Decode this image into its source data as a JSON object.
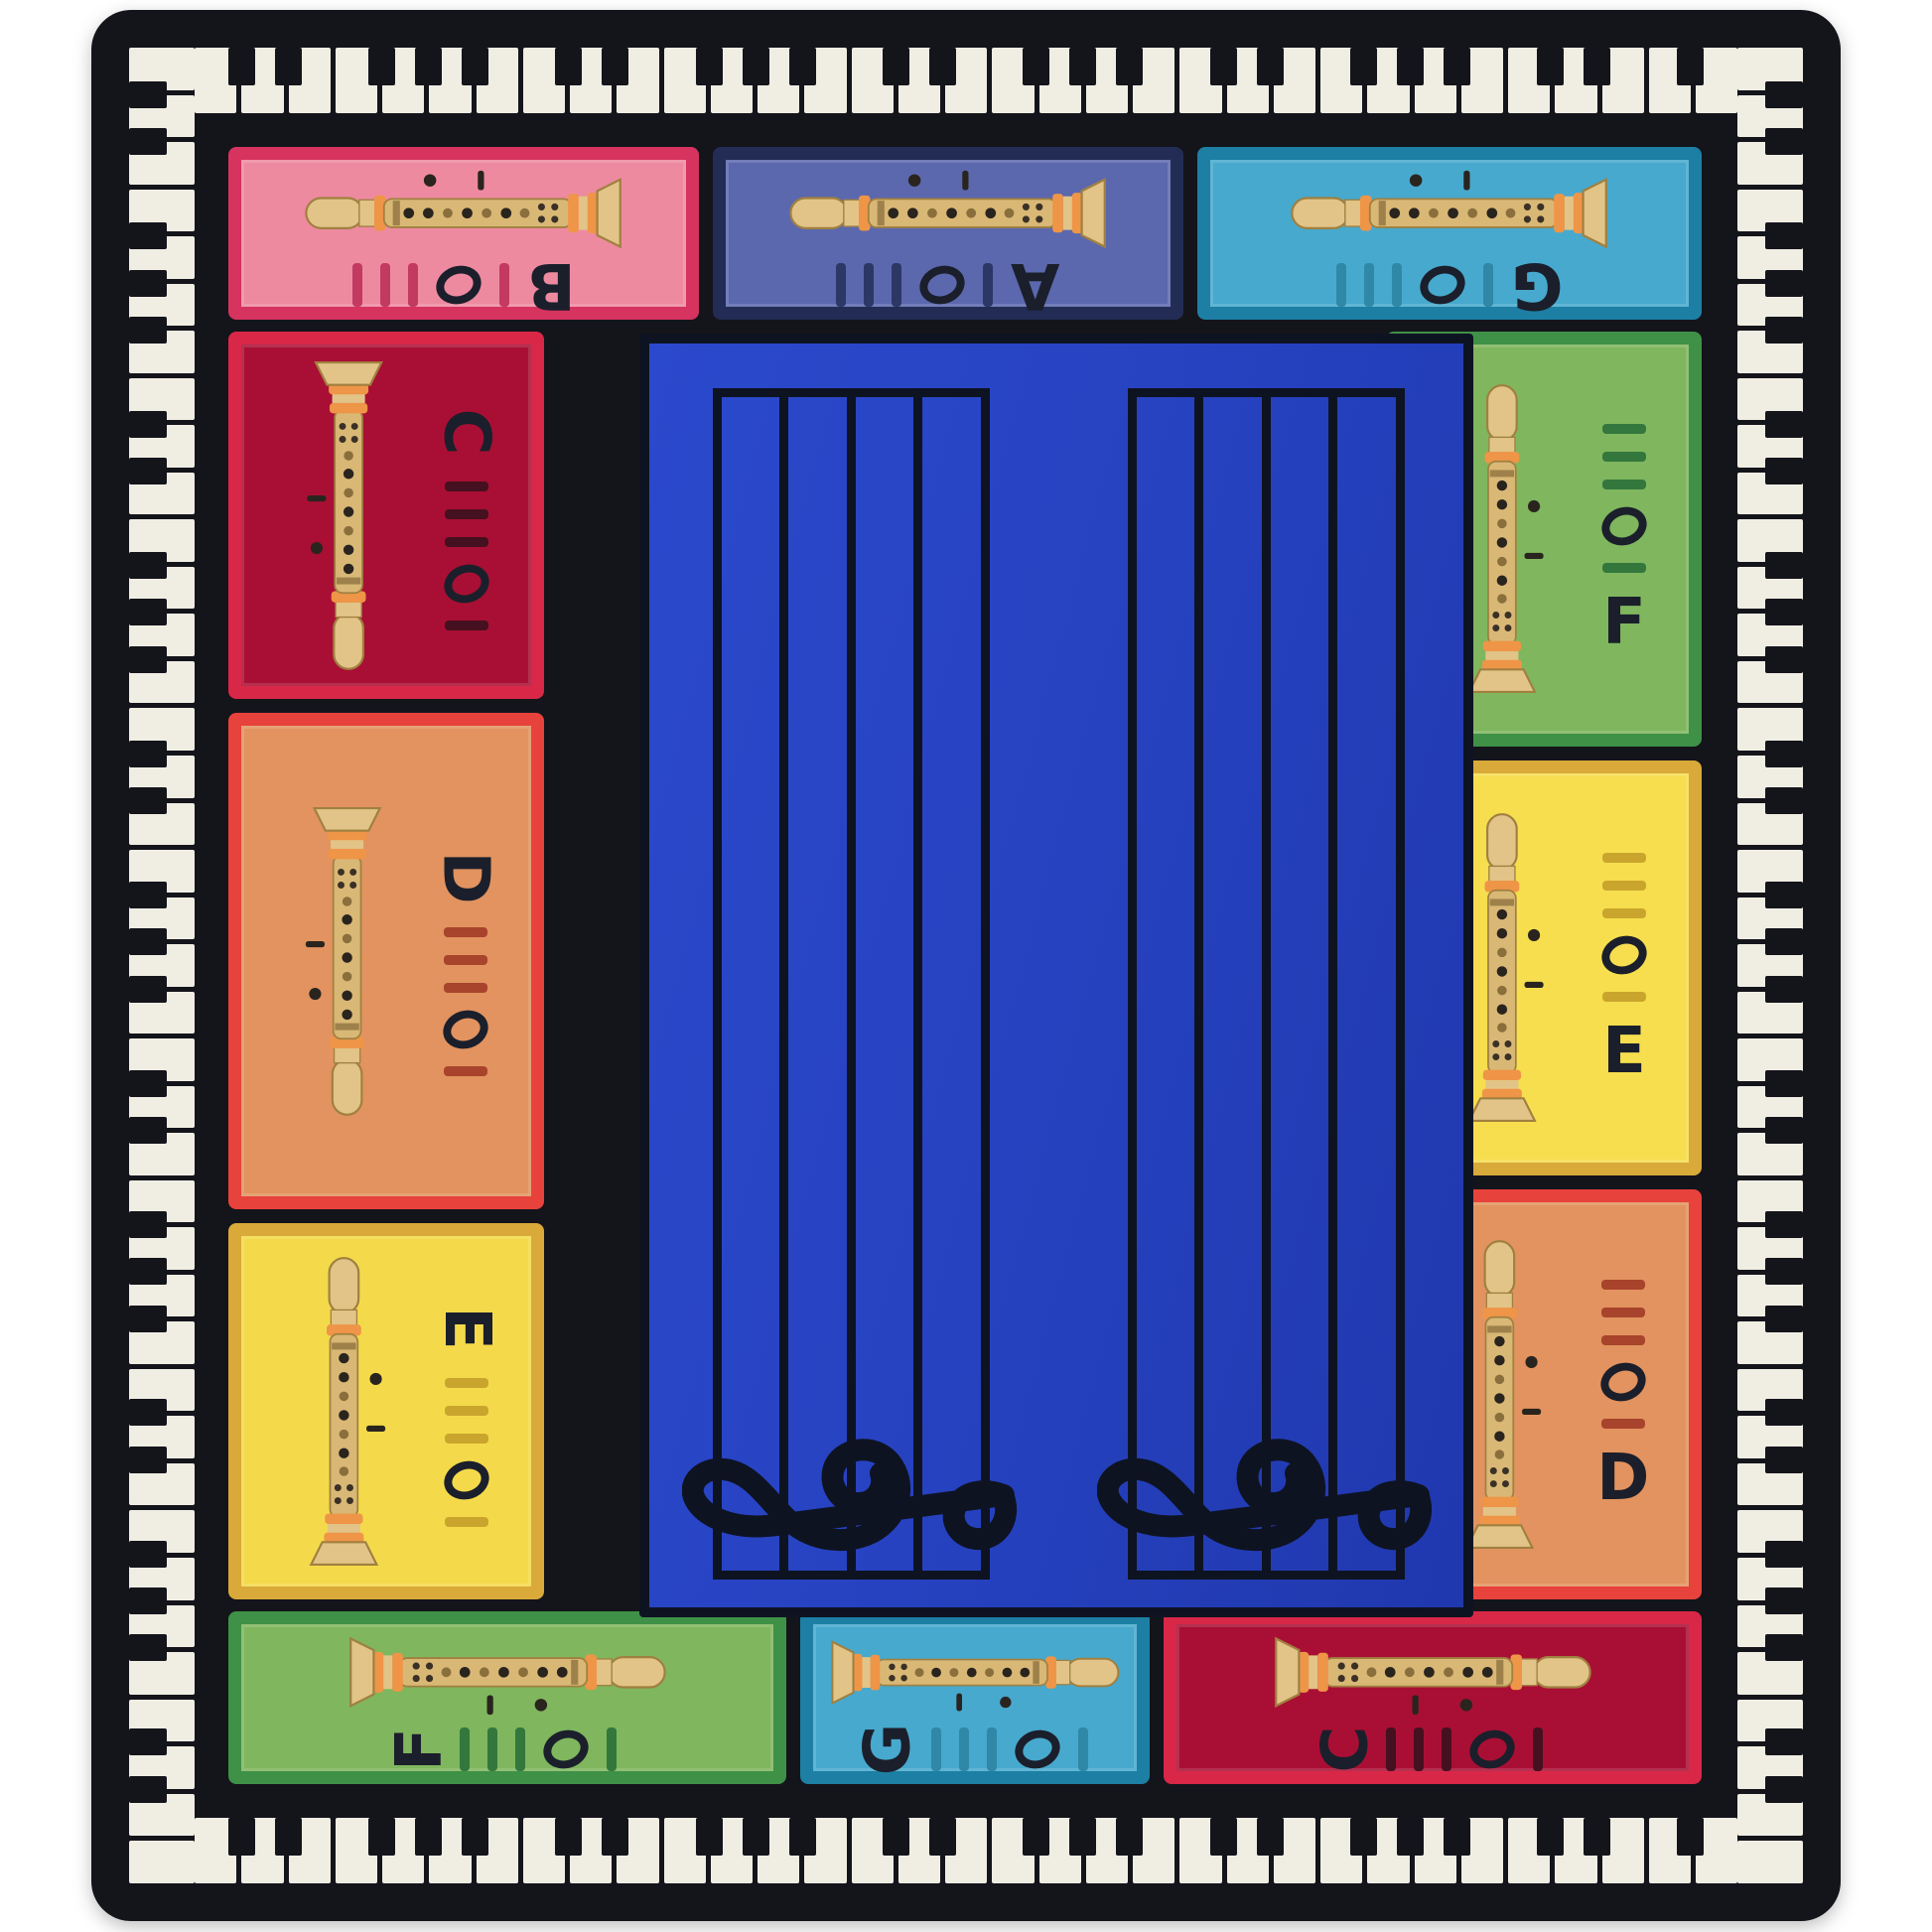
{
  "product": {
    "type": "children music classroom rug",
    "motifs": [
      "piano keyboard border",
      "recorder fingering panels",
      "double music staff with treble clefs"
    ]
  },
  "border": {
    "key_white": "#f0ede3",
    "key_black": "#14141b"
  },
  "center": {
    "background": "#2743c2",
    "staff_color": "#0e1322",
    "staves": 2,
    "lines_per_staff": 5,
    "clef": "treble"
  },
  "recorder": {
    "body": "#d9b876",
    "head": "#e2c488",
    "rings": "#ef9547",
    "holes": "#2a241e",
    "accent": "#8a6f3c"
  },
  "letter_color": "#1b1f2b",
  "panels": [
    {
      "id": "top-1",
      "side": "top",
      "note": "B",
      "bell": "right",
      "body": "#ee8aa0",
      "border": "#d6335f",
      "marks": "#c23a60"
    },
    {
      "id": "top-2",
      "side": "top",
      "note": "A",
      "bell": "right",
      "body": "#5b68ae",
      "border": "#222c55",
      "marks": "#2c3765"
    },
    {
      "id": "top-3",
      "side": "top",
      "note": "G",
      "bell": "right",
      "body": "#47a9cd",
      "border": "#1d7fa4",
      "marks": "#2f88a8"
    },
    {
      "id": "left-1",
      "side": "left",
      "note": "C",
      "bell": "up",
      "body": "#a90f34",
      "border": "#d92747",
      "marks": "#45101f"
    },
    {
      "id": "left-2",
      "side": "left",
      "note": "D",
      "bell": "up",
      "body": "#e2935f",
      "border": "#e8423c",
      "marks": "#a8432c"
    },
    {
      "id": "left-3",
      "side": "left",
      "note": "E",
      "bell": "down",
      "body": "#f4da4a",
      "border": "#d9a93a",
      "marks": "#caa52d"
    },
    {
      "id": "right-1",
      "side": "right",
      "note": "F",
      "bell": "down",
      "body": "#7fb65e",
      "border": "#3f9147",
      "marks": "#33773d"
    },
    {
      "id": "right-2",
      "side": "right",
      "note": "E",
      "bell": "down",
      "body": "#f6de4e",
      "border": "#d9a93a",
      "marks": "#caa52d"
    },
    {
      "id": "right-3",
      "side": "right",
      "note": "D",
      "bell": "down",
      "body": "#e2935f",
      "border": "#e8423c",
      "marks": "#a8432c"
    },
    {
      "id": "bottom-1",
      "side": "bottom",
      "note": "F",
      "bell": "left",
      "body": "#7fb65e",
      "border": "#3f9147",
      "marks": "#33773d"
    },
    {
      "id": "bottom-2",
      "side": "bottom",
      "note": "G",
      "bell": "left",
      "body": "#47a9cd",
      "border": "#1d7fa4",
      "marks": "#2f88a8"
    },
    {
      "id": "bottom-3",
      "side": "bottom",
      "note": "C",
      "bell": "left",
      "body": "#a90f34",
      "border": "#d92747",
      "marks": "#45101f"
    }
  ]
}
